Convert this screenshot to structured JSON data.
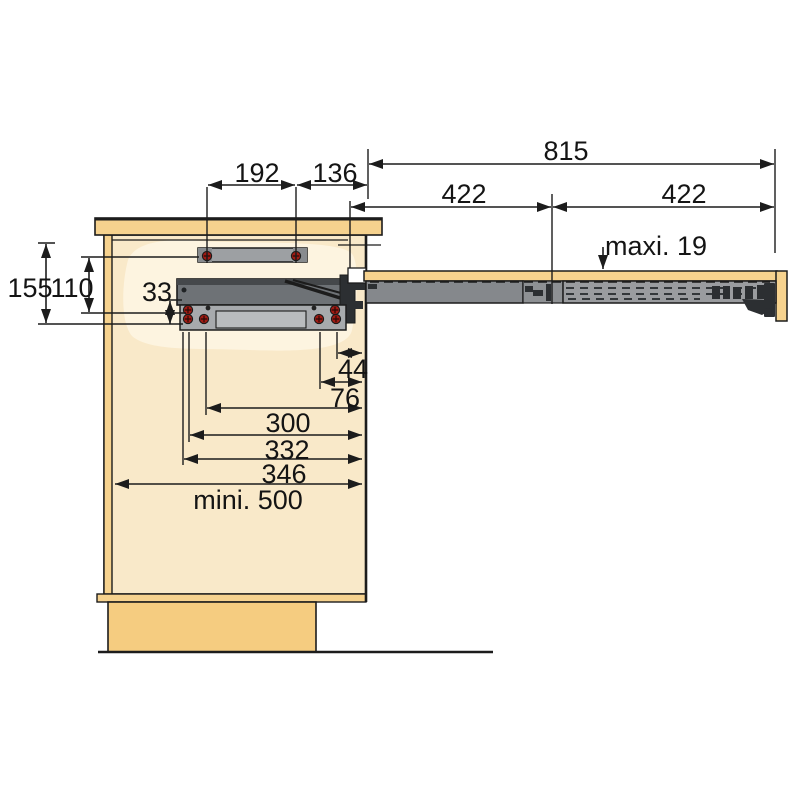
{
  "diagram": {
    "kind": "technical drawing — pull-out table slide mechanism mounted in a cabinet, side view",
    "labels": {
      "d192": "192",
      "d136": "136",
      "d815": "815",
      "d422_left": "422",
      "d422_right": "422",
      "maxi19": "maxi. 19",
      "d155": "155",
      "d110": "110",
      "d33": "33",
      "d44": "44",
      "d76": "76",
      "d300": "300",
      "d332": "332",
      "d346": "346",
      "mini500": "mini. 500"
    },
    "colors": {
      "wood": "#f6d28e",
      "wood_dark": "#f5cc80",
      "wood_light": "#f9e9c9",
      "wood_highlight": "#fdf4e0",
      "rail_dark": "#6e7276",
      "rail_mid": "#85888c",
      "rail_light": "#9a9c9f",
      "bracket": "#a7aaad",
      "bracket_cut": "#b9bcbe",
      "hardware_dark": "#2c2f32",
      "screw_red": "#a01b14",
      "line": "#1c1c1c"
    }
  }
}
